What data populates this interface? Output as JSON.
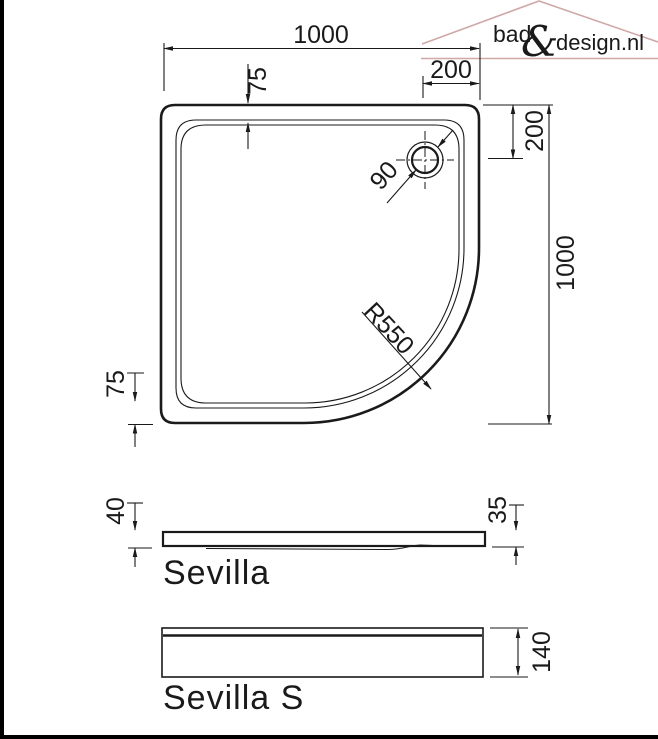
{
  "brand": {
    "prefix": "bad",
    "ampersand": "&",
    "suffix": "design.nl"
  },
  "colors": {
    "logo_gray": "#a8a8a8",
    "logo_rose": "#cfa8a8",
    "ink": "#1a1a1a"
  },
  "top_view": {
    "width": "1000",
    "height": "1000",
    "drain_offset_x": "200",
    "drain_offset_y": "200",
    "rim_top": "75",
    "rim_bottom": "75",
    "drain_diameter": "90",
    "corner_radius": "R550"
  },
  "profiles": {
    "sevilla": {
      "label": "Sevilla",
      "height_left": "40",
      "height_right": "35"
    },
    "sevilla_s": {
      "label": "Sevilla S",
      "height": "140"
    }
  }
}
